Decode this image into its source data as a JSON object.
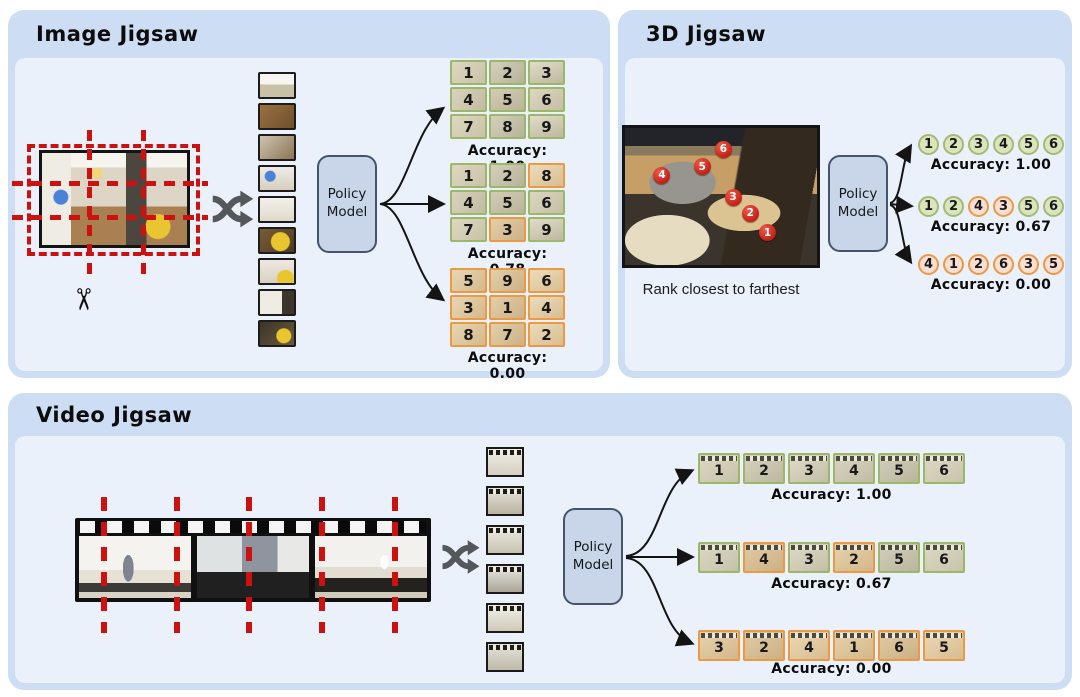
{
  "colors": {
    "panel_outer": "#cddef4",
    "panel_inner": "#eaf1fb",
    "correct_green_border": "#9cb76a",
    "correct_green_fill": "#dbe5bd",
    "circle_green_border": "#a3ba74",
    "incorrect_orange_border": "#eb9a43",
    "incorrect_orange_fill": "#f8ded3",
    "cut_line_red": "#cc1111",
    "marker_red": "#d72f23",
    "policy_fill": "#c9d5e8",
    "policy_border": "#44546a",
    "arrow_black": "#141414",
    "shuffle_gray": "#54585c"
  },
  "icons": {
    "scissors": "✂",
    "shuffle": "crossed-shuffle-arrows"
  },
  "panel_image": {
    "title": "Image Jigsaw",
    "policy_model_label": "Policy\nModel",
    "grids": [
      {
        "accuracy": "Accuracy: 1.00",
        "cells": [
          {
            "n": "1",
            "state": "correct"
          },
          {
            "n": "2",
            "state": "correct"
          },
          {
            "n": "3",
            "state": "correct"
          },
          {
            "n": "4",
            "state": "correct"
          },
          {
            "n": "5",
            "state": "correct"
          },
          {
            "n": "6",
            "state": "correct"
          },
          {
            "n": "7",
            "state": "correct"
          },
          {
            "n": "8",
            "state": "correct"
          },
          {
            "n": "9",
            "state": "correct"
          }
        ]
      },
      {
        "accuracy": "Accuracy: 0.78",
        "cells": [
          {
            "n": "1",
            "state": "correct"
          },
          {
            "n": "2",
            "state": "correct"
          },
          {
            "n": "8",
            "state": "wrong"
          },
          {
            "n": "4",
            "state": "correct"
          },
          {
            "n": "5",
            "state": "correct"
          },
          {
            "n": "6",
            "state": "correct"
          },
          {
            "n": "7",
            "state": "correct"
          },
          {
            "n": "3",
            "state": "wrong"
          },
          {
            "n": "9",
            "state": "correct"
          }
        ]
      },
      {
        "accuracy": "Accuracy: 0.00",
        "cells": [
          {
            "n": "5",
            "state": "wrong"
          },
          {
            "n": "9",
            "state": "wrong"
          },
          {
            "n": "6",
            "state": "wrong"
          },
          {
            "n": "3",
            "state": "wrong"
          },
          {
            "n": "1",
            "state": "wrong"
          },
          {
            "n": "4",
            "state": "wrong"
          },
          {
            "n": "8",
            "state": "wrong"
          },
          {
            "n": "7",
            "state": "wrong"
          },
          {
            "n": "2",
            "state": "wrong"
          }
        ]
      }
    ]
  },
  "panel_3d": {
    "title": "3D Jigsaw",
    "caption": "Rank closest to farthest",
    "policy_model_label": "Policy\nModel",
    "markers": [
      {
        "n": "4",
        "x": 19,
        "y": 34
      },
      {
        "n": "5",
        "x": 40,
        "y": 28
      },
      {
        "n": "6",
        "x": 51,
        "y": 15
      },
      {
        "n": "3",
        "x": 56,
        "y": 50
      },
      {
        "n": "2",
        "x": 65,
        "y": 62
      },
      {
        "n": "1",
        "x": 74,
        "y": 76
      }
    ],
    "sequences": [
      {
        "accuracy": "Accuracy: 1.00",
        "circles": [
          {
            "n": "1",
            "state": "correct"
          },
          {
            "n": "2",
            "state": "correct"
          },
          {
            "n": "3",
            "state": "correct"
          },
          {
            "n": "4",
            "state": "correct"
          },
          {
            "n": "5",
            "state": "correct"
          },
          {
            "n": "6",
            "state": "correct"
          }
        ]
      },
      {
        "accuracy": "Accuracy: 0.67",
        "circles": [
          {
            "n": "1",
            "state": "correct"
          },
          {
            "n": "2",
            "state": "correct"
          },
          {
            "n": "4",
            "state": "wrong"
          },
          {
            "n": "3",
            "state": "wrong"
          },
          {
            "n": "5",
            "state": "correct"
          },
          {
            "n": "6",
            "state": "correct"
          }
        ]
      },
      {
        "accuracy": "Accuracy: 0.00",
        "circles": [
          {
            "n": "4",
            "state": "wrong"
          },
          {
            "n": "1",
            "state": "wrong"
          },
          {
            "n": "2",
            "state": "wrong"
          },
          {
            "n": "6",
            "state": "wrong"
          },
          {
            "n": "3",
            "state": "wrong"
          },
          {
            "n": "5",
            "state": "wrong"
          }
        ]
      }
    ]
  },
  "panel_video": {
    "title": "Video Jigsaw",
    "policy_model_label": "Policy\nModel",
    "sequences": [
      {
        "accuracy": "Accuracy: 1.00",
        "frames": [
          {
            "n": "1",
            "state": "correct"
          },
          {
            "n": "2",
            "state": "correct"
          },
          {
            "n": "3",
            "state": "correct"
          },
          {
            "n": "4",
            "state": "correct"
          },
          {
            "n": "5",
            "state": "correct"
          },
          {
            "n": "6",
            "state": "correct"
          }
        ]
      },
      {
        "accuracy": "Accuracy: 0.67",
        "frames": [
          {
            "n": "1",
            "state": "correct"
          },
          {
            "n": "4",
            "state": "wrong"
          },
          {
            "n": "3",
            "state": "correct"
          },
          {
            "n": "2",
            "state": "wrong"
          },
          {
            "n": "5",
            "state": "correct"
          },
          {
            "n": "6",
            "state": "correct"
          }
        ]
      },
      {
        "accuracy": "Accuracy: 0.00",
        "frames": [
          {
            "n": "3",
            "state": "wrong"
          },
          {
            "n": "2",
            "state": "wrong"
          },
          {
            "n": "4",
            "state": "wrong"
          },
          {
            "n": "1",
            "state": "wrong"
          },
          {
            "n": "6",
            "state": "wrong"
          },
          {
            "n": "5",
            "state": "wrong"
          }
        ]
      }
    ]
  }
}
